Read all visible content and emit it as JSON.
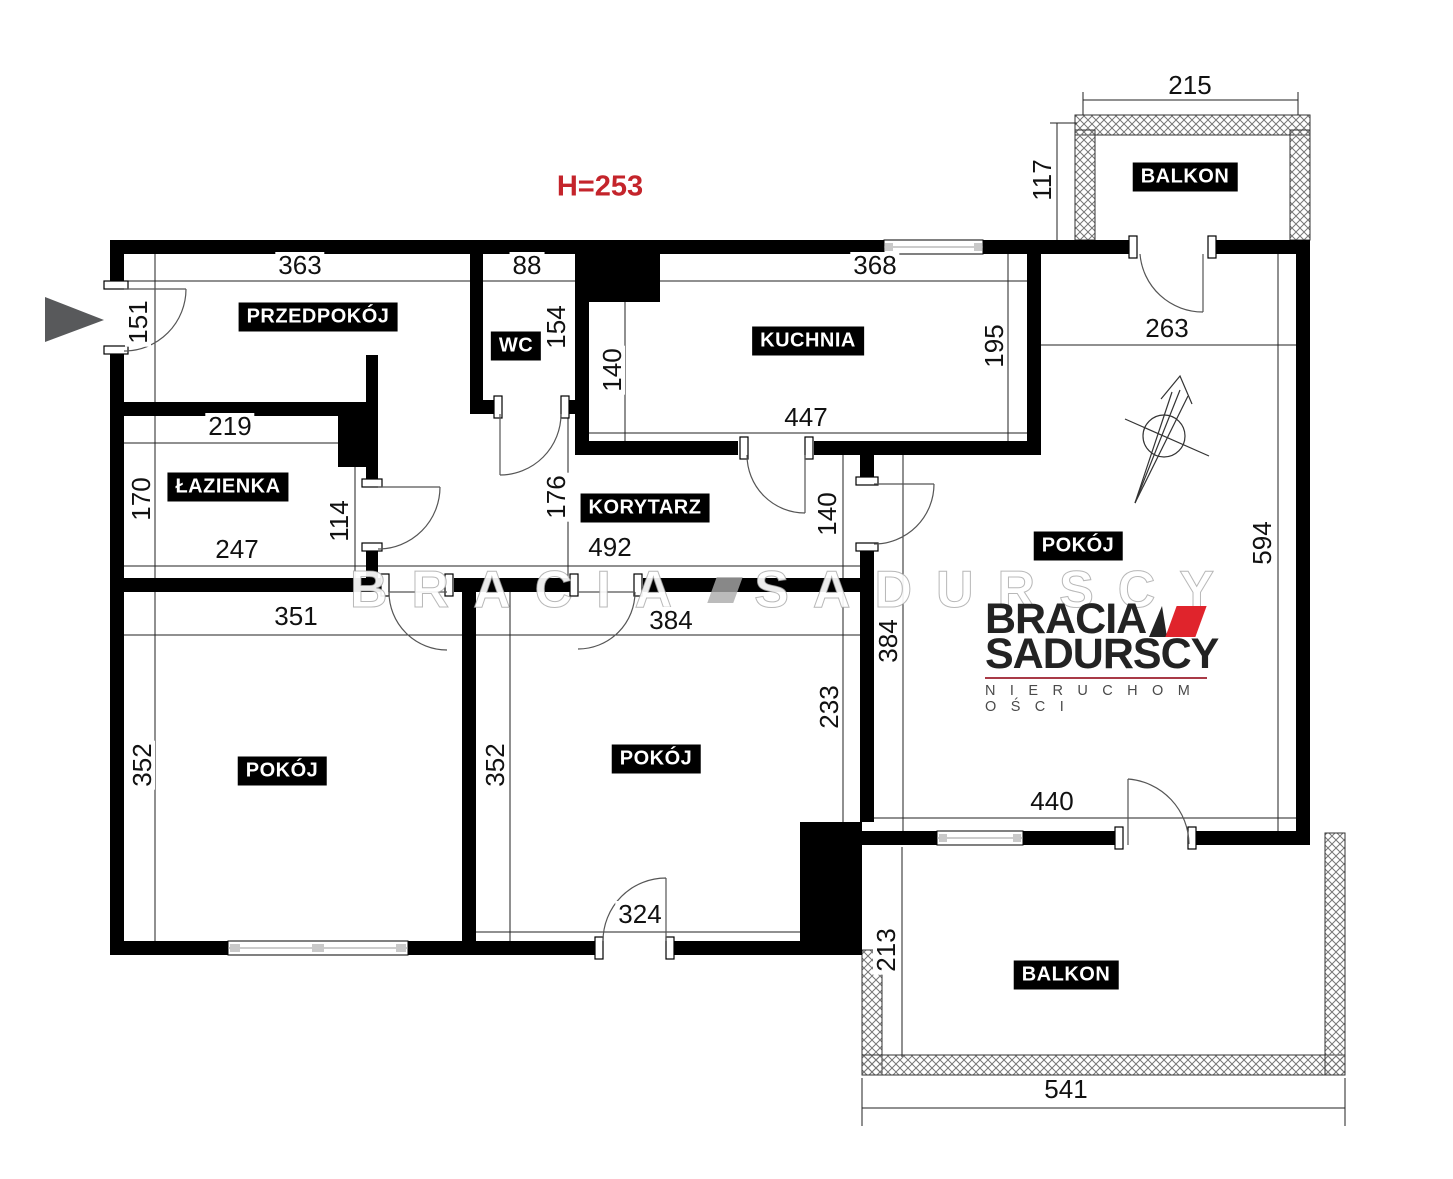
{
  "plan": {
    "height_note": "H=253"
  },
  "rooms": {
    "przedpokoj": "PRZEDPOKÓJ",
    "wc": "WC",
    "kuchnia": "KUCHNIA",
    "lazienka": "ŁAZIENKA",
    "korytarz": "KORYTARZ",
    "pokoj_right": "POKÓJ",
    "pokoj_left": "POKÓJ",
    "pokoj_middle": "POKÓJ",
    "balkon_top": "BALKON",
    "balkon_bottom": "BALKON"
  },
  "dims": {
    "przedpokoj_w": "363",
    "entry_h": "151",
    "wc_w": "88",
    "wc_h": "154",
    "kuchnia_w": "368",
    "balkon_top_w": "215",
    "balkon_top_h": "117",
    "kuchnia_h": "195",
    "kuchnia_left_h": "140",
    "kuchnia_bottom_w": "447",
    "pokoj_right_top_w": "263",
    "lazienka_top_w": "219",
    "lazienka_h": "170",
    "lazienka_bottom_w": "247",
    "lazienka_door_h": "114",
    "korytarz_h": "176",
    "korytarz_w": "492",
    "korytarz_right_h": "140",
    "pokoj_right_h": "594",
    "pokoj_right_left_h": "384",
    "pokoj_left_w": "351",
    "pokoj_middle_w": "384",
    "pokoj_middle_right_h": "233",
    "pokoj_left_h": "352",
    "pokoj_middle_h": "352",
    "pokoj_right_bottom_w": "440",
    "pokoj_middle_bottom_w": "324",
    "balkon_bottom_h": "213",
    "balkon_bottom_w": "541"
  },
  "logo": {
    "brand_top": "BRACIA",
    "brand_bottom": "SADURSCY",
    "tagline": "N I E R U C H O M O Ś C I"
  },
  "watermark": {
    "part1": "BRACIA",
    "part2": "SADURSCY"
  },
  "colors": {
    "wall": "#000000",
    "dim_text": "#111111",
    "accent_red": "#c4242b",
    "logo_red": "#e0242c",
    "logo_dark": "#232323",
    "tagline_gray": "#4a4a4a",
    "entrance_arrow": "#58595b",
    "hatch_gray": "#777777"
  }
}
